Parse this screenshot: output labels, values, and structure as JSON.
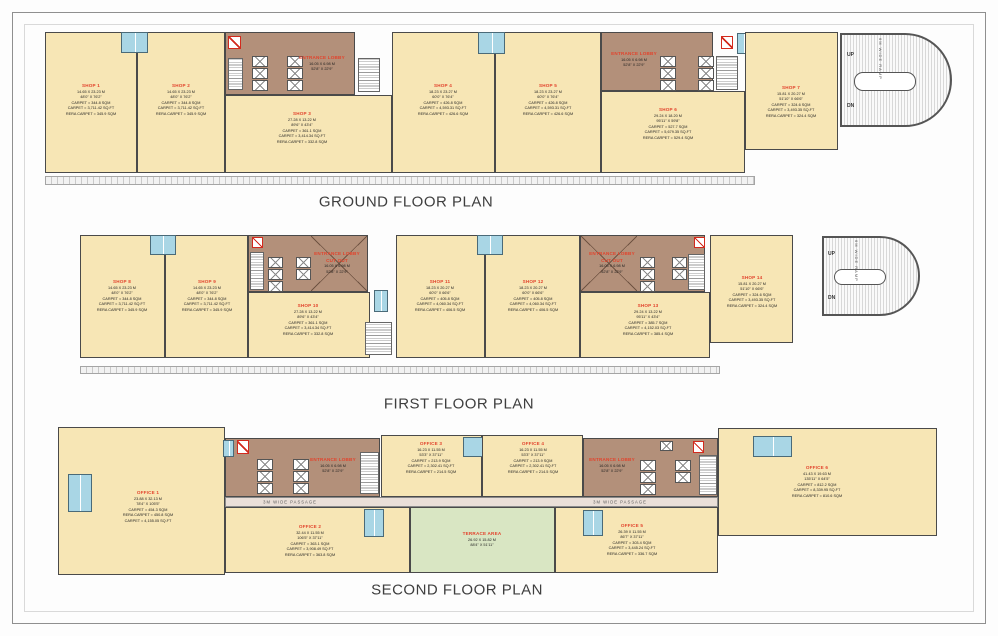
{
  "colors": {
    "shop_fill": "#f7e6b5",
    "lobby_fill": "#b3907a",
    "wet_area_fill": "#a9d6e5",
    "terrace_fill": "#d9e6c3",
    "passage_fill": "#eadfd8",
    "wall": "#4a4a4a",
    "room_name_red": "#e2432c",
    "fire_shaft_red": "#d22a1d"
  },
  "icons": {
    "lift": "box-with-X elevator symbol",
    "stairs": "striped stair treads",
    "wet_area": "blue toilet block",
    "fire_shaft": "red-outlined service shaft",
    "void_cross": "diagonal cross over double-height cutout",
    "ramp": "hatched car ramp with rounded end"
  },
  "titles": {
    "ground": "GROUND FLOOR PLAN",
    "first": "FIRST FLOOR PLAN",
    "second": "SECOND FLOOR PLAN"
  },
  "ramp": {
    "label": "6M WIDE RAMP",
    "up": "UP",
    "down": "DN"
  },
  "passage_label": "3M WIDE PASSAGE",
  "ground": {
    "shop1": {
      "name": "SHOP 1",
      "details": "14.65 X 23.23 M\n48'0\" X 76'2\"\nCARPET = 344.8 SQM\nCARPET = 3,711.42 SQ.FT\nRERA CARPET = 345.9 SQM"
    },
    "shop2": {
      "name": "SHOP 2",
      "details": "14.65 X 23.23 M\n48'0\" X 76'2\"\nCARPET = 344.8 SQM\nCARPET = 3,711.42 SQ.FT\nRERA CARPET = 345.9 SQM"
    },
    "lobby1": {
      "name": "ENTRANCE LOBBY",
      "details": "16.05 X 6.98 M\n52'8\" X 22'9\""
    },
    "shop3": {
      "name": "SHOP 3",
      "details": "27.28 X 13.22 M\n89'6\" X 43'4\"\nCARPET = 361.1 SQM\nCARPET = 3,414.34 SQ.FT\nRERA CARPET = 332.8 SQM"
    },
    "shop4": {
      "name": "SHOP 4",
      "details": "18.23 X 23.27 M\n60'0\" X 76'4\"\nCARPET = 426.8 SQM\nCARPET = 4,593.31 SQ.FT\nRERA CARPET = 426.6 SQM"
    },
    "shop5": {
      "name": "SHOP 5",
      "details": "18.23 X 23.27 M\n60'0\" X 76'4\"\nCARPET = 426.8 SQM\nCARPET = 4,593.31 SQ.FT\nRERA CARPET = 426.6 SQM"
    },
    "lobby2": {
      "name": "ENTRANCE LOBBY",
      "details": "16.05 X 6.98 M\n52'8\" X 22'9\""
    },
    "shop6": {
      "name": "SHOP 6",
      "details": "29.24 X 18.20 M\n95'11\" X 59'8\"\nCARPET = 527.7 SQM\nCARPET = 5,679.35 SQ.FT\nRERA CARPET = 529.4 SQM"
    },
    "shop7": {
      "name": "SHOP 7",
      "details": "15.81 X 20.27 M\n51'10\" X 66'6\"\nCARPET = 324.6 SQM\nCARPET = 3,493.35 SQ.FT\nRERA CARPET = 324.4 SQM"
    }
  },
  "first": {
    "shop8": {
      "name": "SHOP 8",
      "details": "14.65 X 23.23 M\n48'0\" X 76'2\"\nCARPET = 344.8 SQM\nCARPET = 3,711.42 SQ.FT\nRERA CARPET = 345.9 SQM"
    },
    "shop9": {
      "name": "SHOP 9",
      "details": "14.65 X 23.23 M\n48'0\" X 76'2\"\nCARPET = 344.8 SQM\nCARPET = 3,711.42 SQ.FT\nRERA CARPET = 345.9 SQM"
    },
    "lobby1": {
      "name": "ENTRANCE LOBBY\nCUT OUT",
      "details": "16.05 X 6.98 M\n52'8\" X 22'9\""
    },
    "shop10": {
      "name": "SHOP 10",
      "details": "27.28 X 13.22 M\n89'6\" X 43'4\"\nCARPET = 361.1 SQM\nCARPET = 3,414.34 SQ.FT\nRERA CARPET = 332.8 SQM"
    },
    "shop11": {
      "name": "SHOP 11",
      "details": "18.23 X 20.27 M\n60'0\" X 66'6\"\nCARPET = 405.8 SQM\nCARPET = 4,060.34 SQ.FT\nRERA CARPET = 406.5 SQM"
    },
    "shop12": {
      "name": "SHOP 12",
      "details": "18.23 X 20.27 M\n60'0\" X 66'6\"\nCARPET = 405.8 SQM\nCARPET = 4,060.34 SQ.FT\nRERA CARPET = 406.5 SQM"
    },
    "lobby2": {
      "name": "ENTRANCE LOBBY\nCUT OUT",
      "details": "16.05 X 6.98 M\n52'8\" X 22'9\""
    },
    "shop13": {
      "name": "SHOP 13",
      "details": "29.24 X 13.22 M\n95'11\" X 43'4\"\nCARPET = 385.7 SQM\nCARPET = 4,152.03 SQ.FT\nRERA CARPET = 385.4 SQM"
    },
    "shop14": {
      "name": "SHOP 14",
      "details": "15.81 X 20.27 M\n51'10\" X 66'6\"\nCARPET = 324.6 SQM\nCARPET = 3,493.35 SQ.FT\nRERA CARPET = 324.4 SQM"
    }
  },
  "second": {
    "office1": {
      "name": "OFFICE 1",
      "details": "23.88 X 32.13 M\n78'4\" X 105'5\"\nCARPET = 454.3 SQM\nRERA CARPET = 450.8 SQM\nCARPET = 4,155.05 SQ.FT"
    },
    "lobby1": {
      "name": "ENTRANCE LOBBY",
      "details": "16.05 X 6.98 M\n52'8\" X 22'9\""
    },
    "office2": {
      "name": "OFFICE 2",
      "details": "32.44 X 11.55 M\n106'5\" X 37'11\"\nCARPET = 363.1 SQM\nCARPET = 3,908.49 SQ.FT\nRERA CARPET = 363.8 SQM"
    },
    "office3": {
      "name": "OFFICE 3",
      "details": "16.23 X 11.55 M\n53'3\" X 37'11\"\nCARPET = 213.9 SQM\nCARPET = 2,302.41 SQ.FT\nRERA CARPET = 214.5 SQM"
    },
    "office4": {
      "name": "OFFICE 4",
      "details": "16.23 X 11.55 M\n53'3\" X 37'11\"\nCARPET = 213.9 SQM\nCARPET = 2,302.41 SQ.FT\nRERA CARPET = 214.5 SQM"
    },
    "lobby2": {
      "name": "ENTRANCE LOBBY",
      "details": "16.05 X 6.98 M\n52'8\" X 22'9\""
    },
    "terrace": {
      "name": "TERRACE AREA",
      "details": "26.92 X 15.82 M\n88'4\" X 51'11\""
    },
    "office5": {
      "name": "OFFICE 5",
      "details": "26.39 X 11.55 M\n86'7\" X 37'11\"\nCARPET = 303.4 SQM\nCARPET = 3,445.24 SQ.FT\nRERA CARPET = 336.7 SQM"
    },
    "office6": {
      "name": "OFFICE 6",
      "details": "41.43 X 19.63 M\n135'11\" X 64'5\"\nCARPET = 812.2 SQM\nCARPET = 8,339.95 SQ.FT\nRERA CARPET = 810.6 SQM"
    }
  }
}
